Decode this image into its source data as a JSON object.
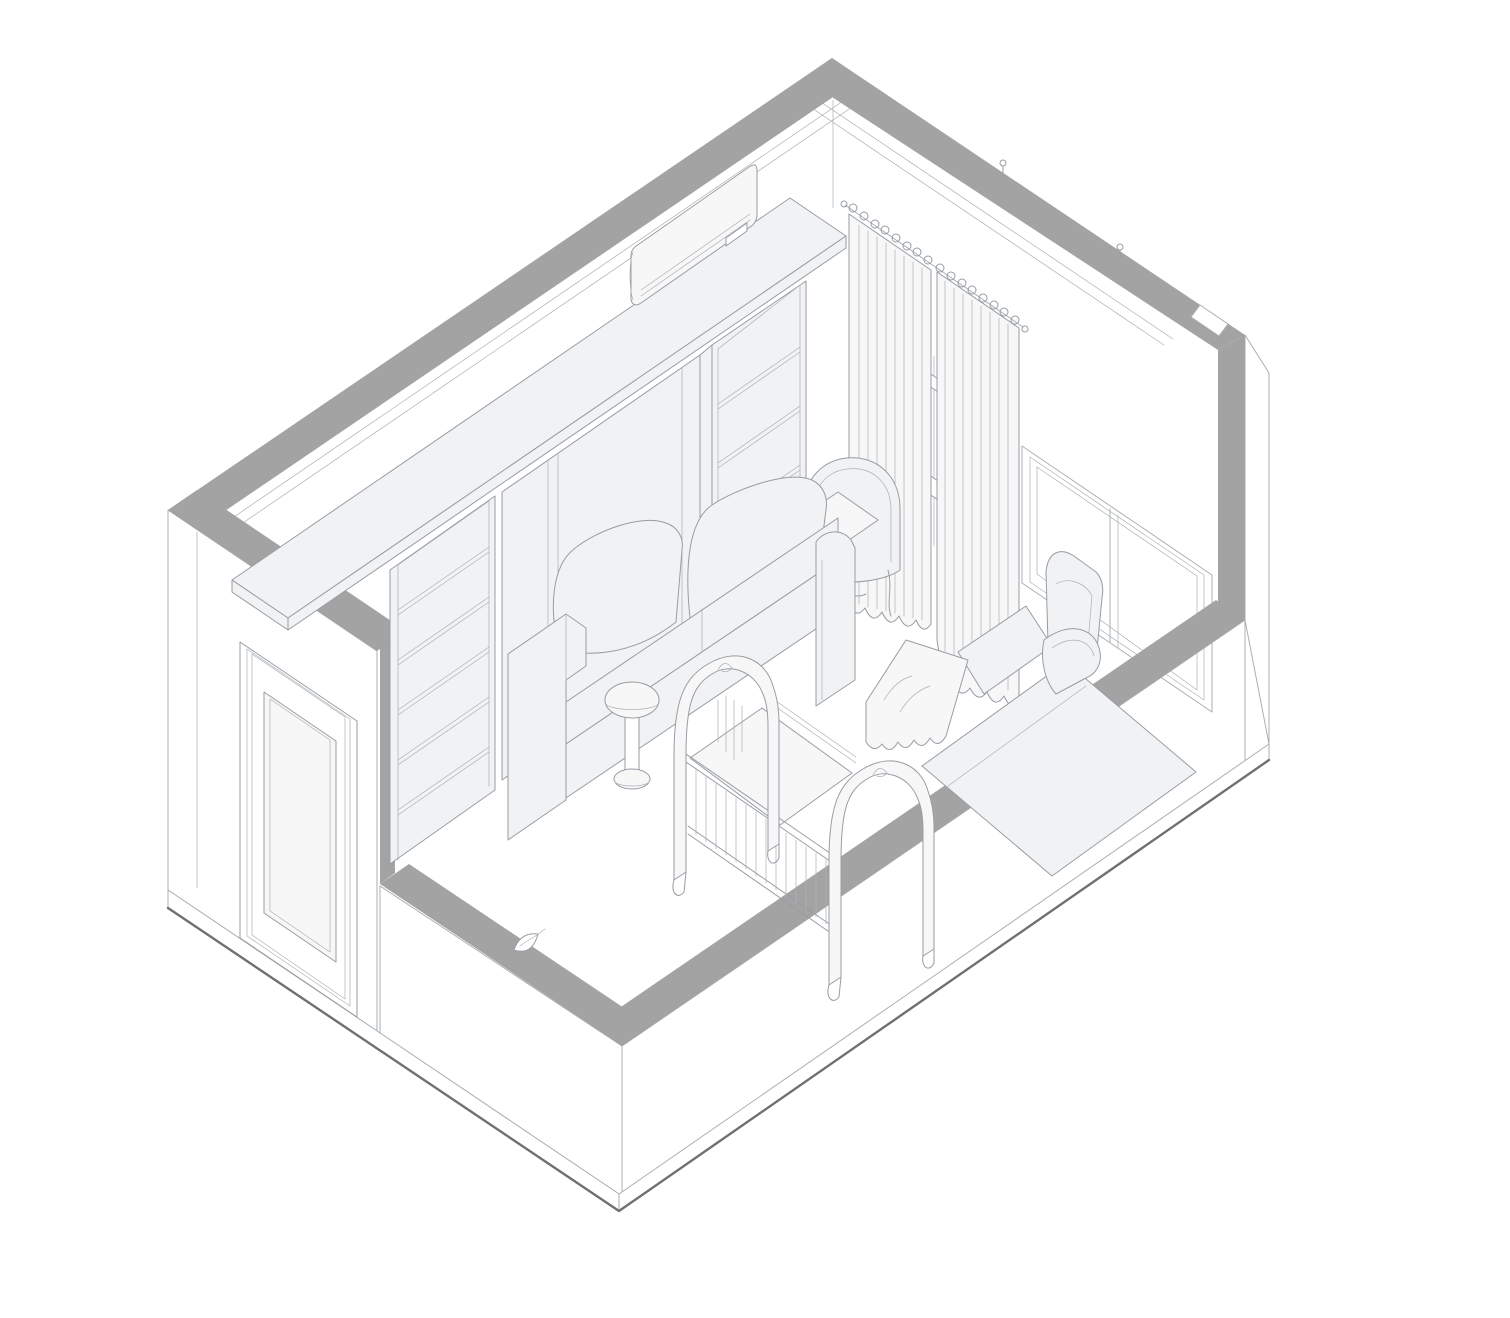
{
  "meta": {
    "title": "Axonometric cutaway line drawing of a nursery room with murphy-bed wall unit, sofa, crib, daybed, recliner, curtains and corner window",
    "drawing_type": "architectural-isometric-line-drawing",
    "has_text": false
  },
  "colors": {
    "paper": "#ffffff",
    "wall-cut": "#a3a3a3",
    "line": "#aab0b5",
    "line-strong": "#979da3",
    "line-dark": "#6e7072",
    "fill-light": "#f1f2f3",
    "fill-lighter": "#f7f7f8"
  },
  "objects": [
    {
      "id": "wall-cap-nw",
      "label": "Cut top of rear-left wall (gray)"
    },
    {
      "id": "wall-cap-ne",
      "label": "Cut top of rear-right wall (gray)"
    },
    {
      "id": "corner-pillar",
      "label": "Cut corner pillar at right (gray)"
    },
    {
      "id": "wall-cap-se",
      "label": "Cut top of low front-right window wall (gray)"
    },
    {
      "id": "wall-cap-sw",
      "label": "Cut top of low front-left wall (gray)"
    },
    {
      "id": "floor-slab",
      "label": "Floor slab with dark bottom edges"
    },
    {
      "id": "door",
      "label": "Paneled entry door on left exterior wall"
    },
    {
      "id": "bookshelf-left",
      "label": "Open bookshelf, left bay of wall unit"
    },
    {
      "id": "murphy-bed-panel",
      "label": "Murphy-bed / wardrobe center panel"
    },
    {
      "id": "bookshelf-right",
      "label": "Open bookshelf, right bay of wall unit"
    },
    {
      "id": "top-shelf-board",
      "label": "Deep top board bridging the wall unit"
    },
    {
      "id": "air-conditioner",
      "label": "Wall mounted air-conditioning unit"
    },
    {
      "id": "curtain-rod",
      "label": "Curtain rod with rings"
    },
    {
      "id": "curtain-left",
      "label": "Left curtain panel"
    },
    {
      "id": "curtain-right",
      "label": "Right curtain panel"
    },
    {
      "id": "window-handle",
      "label": "Window latch visible between curtains"
    },
    {
      "id": "window-frame",
      "label": "Corner window behind cut band"
    },
    {
      "id": "sofa",
      "label": "Two-seat sofa with back pillows"
    },
    {
      "id": "side-table",
      "label": "Round pedestal side table"
    },
    {
      "id": "daybed",
      "label": "Carved daybed / bench against rear wall"
    },
    {
      "id": "crib",
      "label": "Baby crib with arched ends and slats"
    },
    {
      "id": "recliner",
      "label": "Recliner armchair with extended leg rest"
    },
    {
      "id": "blanket",
      "label": "Draped blanket with zigzag hem"
    },
    {
      "id": "door-stopper-leaf",
      "label": "Small leaf-shaped object on cut wall"
    },
    {
      "id": "wall-clip-1",
      "label": "Small clip on rear-right wall cap"
    },
    {
      "id": "wall-clip-2",
      "label": "Small clip near corner notch"
    }
  ]
}
